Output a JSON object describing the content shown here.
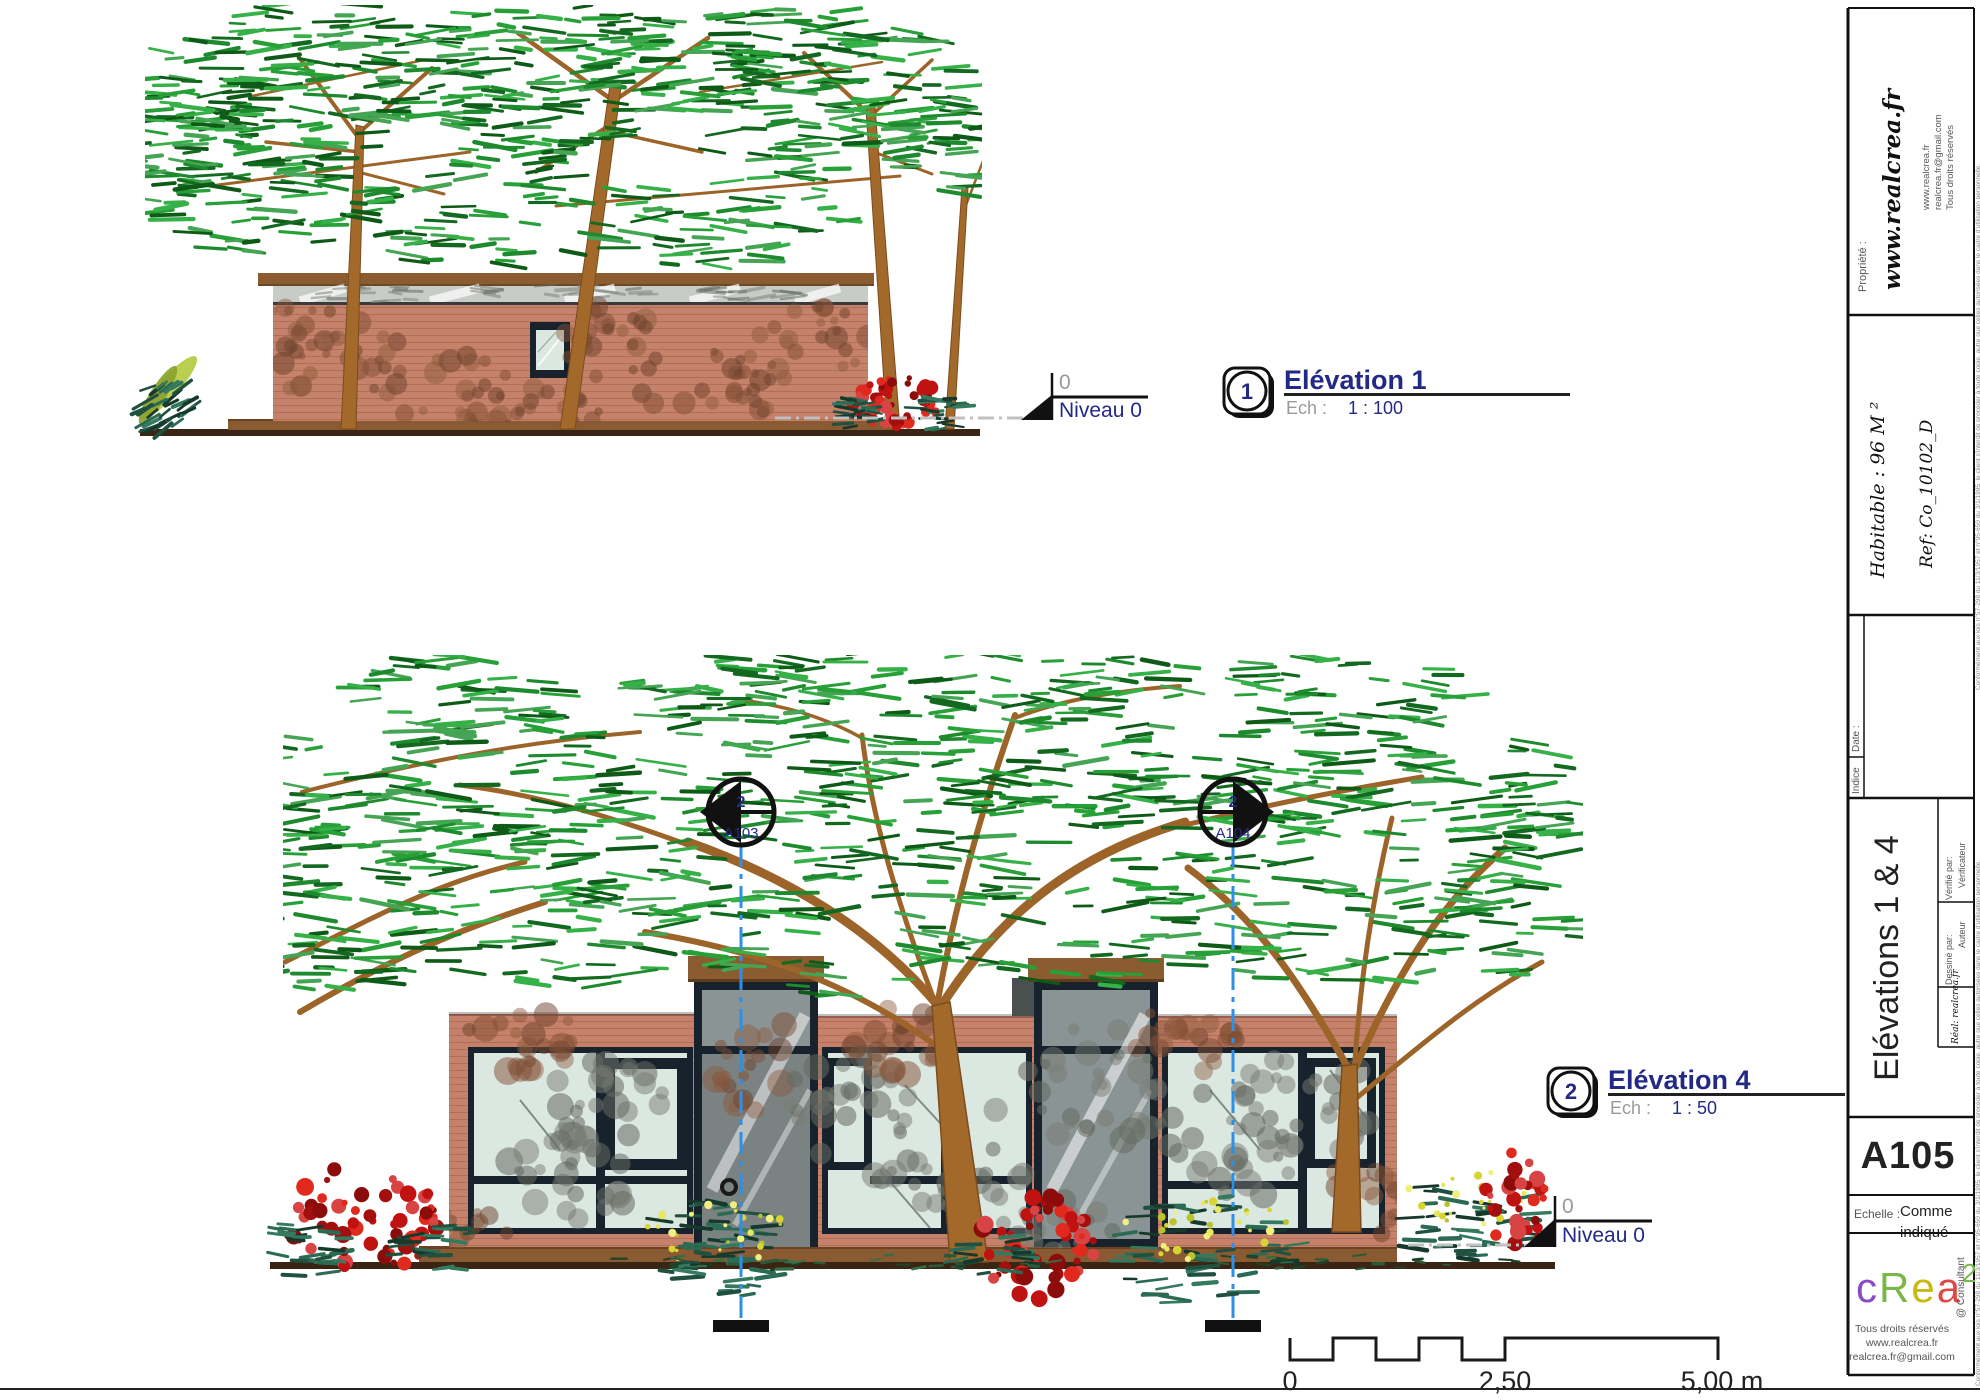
{
  "views": {
    "elev1": {
      "number": "1",
      "title": "Elévation 1",
      "scale_label": "Ech :",
      "scale_value": "1 : 100",
      "level_value": "0",
      "level_name": "Niveau 0"
    },
    "elev4": {
      "number": "2",
      "title": "Elévation 4",
      "scale_label": "Ech :",
      "scale_value": "1 : 50",
      "level_value": "0",
      "level_name": "Niveau 0",
      "sections": [
        {
          "detail": "2",
          "sheet": "A103"
        },
        {
          "detail": "2",
          "sheet": "A104"
        }
      ]
    }
  },
  "scale_bar": {
    "start": "0",
    "mid": "2,50",
    "end": "5,00 m"
  },
  "title_block": {
    "property_label": "Propriété :",
    "property_value": "www.realcrea.fr",
    "contact_lines": [
      "www.realcrea.fr",
      "realcrea.fr@gmail.com",
      "Tous droits réservés"
    ],
    "area": "Habitable : 96 M ²",
    "ref": "Ref: Co_10102_D",
    "date_label": "Date :",
    "index_label": "Indice",
    "sheet_title": "Elévations 1 & 4",
    "checked_by_label": "Vérifié par:",
    "checked_by_value": "Vérificateur",
    "drawn_by_label": "Dessiné par:",
    "drawn_by_value": "Auteur",
    "real_by": "Réal: realcrea.fr",
    "sheet_number": "A105",
    "scale_label": "Echelle :",
    "scale_value": "Comme indiqué",
    "scale_value_lines": [
      "Comme",
      "indiqué"
    ],
    "consultant": "@ Consultant",
    "footer_lines": [
      "Tous droits réservés",
      "www.realcrea.fr",
      "realcrea.fr@gmail.com"
    ],
    "legal_edge": "Conformément aux lois n°57-298 du 11/3/1957 et n°95-650 du 3/1/1995, le client s'interdit de procéder à toute copie, autre que celles autorisées dans le cadre d'utilisation personnelle.",
    "logo_letters": [
      {
        "ch": "c",
        "color": "#8a4bc8"
      },
      {
        "ch": "R",
        "color": "#7ab648"
      },
      {
        "ch": "e",
        "color": "#c8ba10"
      },
      {
        "ch": "a",
        "color": "#e04848"
      },
      {
        "ch": "2",
        "color": "#7ab648",
        "sup": true
      },
      {
        "ch": "l",
        "color": "#6cc8e8",
        "afterSup": true
      }
    ]
  },
  "colors": {
    "navy": "#232a85",
    "gray_label": "#9a9a9a",
    "section_blue": "#2f8fe8",
    "wall": "#c58169",
    "frame": "#17222c",
    "glass": "#dbe7e1",
    "glass_band": "#c7ccc7",
    "tower_glass": "#8b9494",
    "door_gray": "#7a8282",
    "roof_brown": "#8a5c30",
    "deck": "#8a5a33",
    "ground": "#3a2414"
  }
}
